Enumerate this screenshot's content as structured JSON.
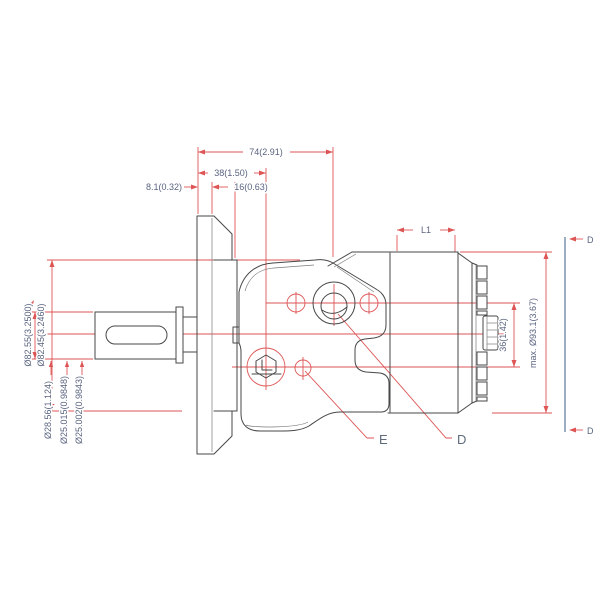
{
  "drawing": {
    "top_dims": {
      "overall_length": "74(2.91)",
      "face_to_port_axis": "38(1.50)",
      "flange_thickness": "8.1(0.32)",
      "pilot_depth": "16(0.63)"
    },
    "left_dims": {
      "pilot_dia_max": "Ø82.55(3.2500)",
      "pilot_dia_min": "Ø82.45(3.2460)",
      "key_measure": "Ø28.56(1.124)",
      "shaft_dia_max": "Ø25.015(0.9848)",
      "shaft_dia_min": "Ø25.002(0.9843)"
    },
    "right_dims": {
      "length_var": "L1",
      "max_dia": "max. Ø93.1(3.67)",
      "port_spacing": "36(1.42)"
    },
    "section_labels": {
      "top": "D",
      "bottom": "D"
    },
    "port_labels": {
      "port_d": "D",
      "port_e": "E"
    },
    "colors": {
      "dimension_red": "#dd5555",
      "label_blue": "#5a6480",
      "geometry_gray": "#474747",
      "section_blue": "#7a93ad"
    }
  }
}
